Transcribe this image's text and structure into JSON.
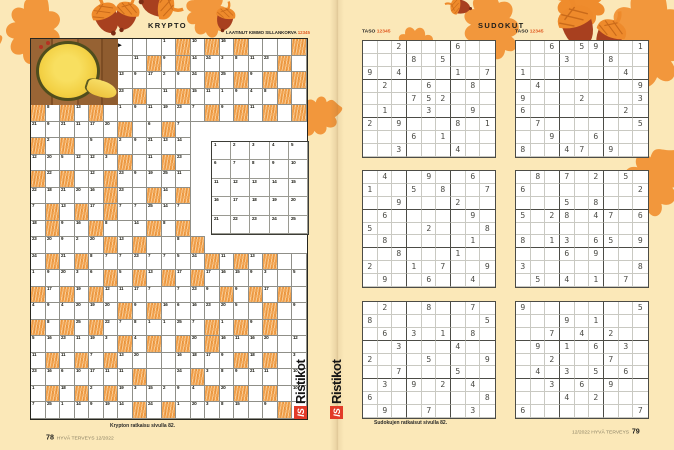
{
  "colors": {
    "background": "#fbe8b8",
    "leaf_orange": "#f2973c",
    "acorn_brown": "#a8401f",
    "acorn_cap": "#ee8a2b",
    "cell_orange": "#f1a04b",
    "logo_red": "#e23b28",
    "scale_orange": "#e0581f"
  },
  "left_page": {
    "title": "KRYPTO",
    "byline": "LAATINUT KIMMO SILLANKORVA",
    "byline_scale": "12345",
    "solution_note": "Krypton ratkaisu sivulla 82.",
    "page_number": "78",
    "magazine_credit": "HYVÄ TERVEYS 12/2022",
    "krypto": {
      "cols": 19,
      "rows": 23,
      "legend": {
        "P": "photo",
        "V": "void",
        "O": "orange-cell",
        "A": "arrow-cell"
      },
      "grid": [
        [
          "P",
          "P",
          "P",
          "P",
          "P",
          "P",
          "A",
          "",
          "",
          "1",
          "O",
          "10",
          "O",
          "16",
          "O",
          "",
          "",
          "",
          "O"
        ],
        [
          "P",
          "P",
          "P",
          "P",
          "P",
          "P",
          "",
          "11",
          "O",
          "9",
          "O",
          "14",
          "24",
          "3",
          "8",
          "11",
          "23",
          "O",
          ""
        ],
        [
          "P",
          "P",
          "P",
          "P",
          "P",
          "P",
          "13",
          "9",
          "17",
          "2",
          "9",
          "24",
          "O",
          "25",
          "O",
          "9",
          "O",
          "",
          "O"
        ],
        [
          "P",
          "P",
          "P",
          "P",
          "P",
          "P",
          "23",
          "O",
          "",
          "11",
          "O",
          "15",
          "11",
          "1",
          "9",
          "4",
          "8",
          "O",
          ""
        ],
        [
          "O",
          "8",
          "O",
          "13",
          "O",
          "",
          "1",
          "9",
          "11",
          "19",
          "23",
          "7",
          "O",
          "9",
          "O",
          "11",
          "O",
          "",
          "O"
        ],
        [
          "21",
          "9",
          "21",
          "11",
          "17",
          "20",
          "O",
          "",
          "6",
          "O",
          "7",
          "V",
          "V",
          "V",
          "V",
          "V",
          "V",
          "V",
          "V"
        ],
        [
          "O",
          "2",
          "O",
          "",
          "5",
          "O",
          "2",
          "9",
          "21",
          "13",
          "14",
          "V",
          "V",
          "V",
          "V",
          "V",
          "V",
          "V",
          "V"
        ],
        [
          "12",
          "20",
          "5",
          "12",
          "12",
          "3",
          "O",
          "",
          "11",
          "O",
          "23",
          "V",
          "V",
          "V",
          "V",
          "V",
          "V",
          "V",
          "V"
        ],
        [
          "O",
          "22",
          "O",
          "",
          "12",
          "O",
          "23",
          "9",
          "19",
          "25",
          "11",
          "V",
          "V",
          "V",
          "V",
          "V",
          "V",
          "V",
          "V"
        ],
        [
          "22",
          "18",
          "21",
          "20",
          "16",
          "O",
          "23",
          "",
          "O",
          "14",
          "O",
          "V",
          "V",
          "V",
          "V",
          "V",
          "V",
          "V",
          "V"
        ],
        [
          "7",
          "O",
          "13",
          "O",
          "17",
          "O",
          "7",
          "7",
          "25",
          "14",
          "7",
          "V",
          "V",
          "V",
          "V",
          "V",
          "V",
          "V",
          "V"
        ],
        [
          "18",
          "O",
          "9",
          "16",
          "O",
          "8",
          "",
          "14",
          "O",
          "8",
          "O",
          "V",
          "V",
          "V",
          "V",
          "V",
          "V",
          "V",
          "V"
        ],
        [
          "23",
          "20",
          "9",
          "2",
          "20",
          "O",
          "13",
          "O",
          "",
          "",
          "8",
          "O",
          "V",
          "V",
          "V",
          "V",
          "V",
          "V",
          "V"
        ],
        [
          "24",
          "O",
          "21",
          "O",
          "8",
          "7",
          "7",
          "23",
          "7",
          "7",
          "5",
          "24",
          "O",
          "11",
          "O",
          "13",
          "O",
          "",
          ""
        ],
        [
          "1",
          "9",
          "20",
          "3",
          "6",
          "O",
          "5",
          "O",
          "13",
          "O",
          "17",
          "O",
          "17",
          "16",
          "15",
          "9",
          "3",
          "",
          "5"
        ],
        [
          "O",
          "17",
          "O",
          "19",
          "O",
          "12",
          "11",
          "17",
          "7",
          "",
          "7",
          "23",
          "9",
          "O",
          "9",
          "O",
          "17",
          "O",
          ""
        ],
        [
          "4",
          "9",
          "4",
          "20",
          "19",
          "20",
          "O",
          "9",
          "O",
          "16",
          "6",
          "16",
          "23",
          "20",
          "5",
          "",
          "O",
          "",
          "9"
        ],
        [
          "O",
          "8",
          "O",
          "25",
          "O",
          "22",
          "7",
          "8",
          "1",
          "1",
          "25",
          "7",
          "O",
          "1",
          "O",
          "9",
          "O",
          "",
          ""
        ],
        [
          "5",
          "16",
          "23",
          "11",
          "19",
          "3",
          "O",
          "4",
          "O",
          "",
          "O",
          "20",
          "O",
          "16",
          "11",
          "16",
          "20",
          "",
          "12"
        ],
        [
          "11",
          "O",
          "11",
          "O",
          "7",
          "O",
          "13",
          "20",
          "",
          "",
          "16",
          "18",
          "17",
          "9",
          "O",
          "18",
          "O",
          "",
          "3"
        ],
        [
          "23",
          "16",
          "6",
          "10",
          "17",
          "11",
          "11",
          "O",
          "",
          "",
          "24",
          "O",
          "3",
          "8",
          "9",
          "21",
          "11",
          "",
          "10"
        ],
        [
          "1",
          "O",
          "18",
          "O",
          "2",
          "O",
          "19",
          "3",
          "15",
          "2",
          "9",
          "4",
          "O",
          "20",
          "O",
          "",
          "O",
          "",
          "10"
        ],
        [
          "7",
          "25",
          "1",
          "14",
          "9",
          "19",
          "14",
          "O",
          "24",
          "O",
          "1",
          "20",
          "3",
          "8",
          "15",
          "",
          "9",
          "O",
          ""
        ]
      ],
      "reference": [
        "1",
        "2",
        "3",
        "4",
        "5",
        "6",
        "7",
        "8",
        "9",
        "10",
        "11",
        "12",
        "13",
        "14",
        "15",
        "16",
        "17",
        "18",
        "19",
        "20",
        "21",
        "22",
        "23",
        "24",
        "25"
      ]
    }
  },
  "right_page": {
    "title": "SUDOKUT",
    "taso_label": "TASO",
    "taso_scale": "12345",
    "solution_note": "Sudokujen ratkaisut sivulla 82.",
    "magazine_credit": "12/2022 HYVÄ TERVEYS",
    "page_number": "79",
    "sudokus": [
      {
        "grid": [
          "..2...6..",
          "...8.5...",
          "9.4...1.7",
          ".2..6..8.",
          "...752...",
          ".1..3..9.",
          "2.9...8.1",
          "...6.1...",
          "..3...4.."
        ]
      },
      {
        "grid": [
          "..6.59..1",
          "...3..8..",
          "1......4.",
          ".4......9",
          "9...2...3",
          "6......2.",
          ".7......5",
          "..9..6...",
          "8..47.9.."
        ]
      },
      {
        "grid": [
          ".4..9..6.",
          "1..5.8..7",
          "..9...2..",
          ".6.....9.",
          "5...2...8",
          ".8.....1.",
          "..8...1..",
          "2..1.7..9",
          ".9..6..4."
        ]
      },
      {
        "grid": [
          ".8.7.2.5.",
          "6.......2",
          "...5.8...",
          "5.28.47.6",
          ".........",
          "8.13.65.9",
          "...6.9...",
          "3.......8",
          ".5.4.1.7."
        ]
      },
      {
        "grid": [
          ".2..8..7.",
          "8.......5",
          ".6.3.1.8.",
          "..3...4..",
          "2...5...9",
          "..7...5..",
          ".3.9.2.4.",
          "6.......8",
          ".9..7..3."
        ]
      },
      {
        "grid": [
          "9.......5",
          "...9.1...",
          "..7.4.2..",
          ".9.1.6.3.",
          "..2...7..",
          ".4.3.5.6.",
          "..3.6.9..",
          "...4.2...",
          "6.......7"
        ]
      }
    ]
  },
  "logo": {
    "badge": "IS",
    "name": "Ristikot"
  }
}
